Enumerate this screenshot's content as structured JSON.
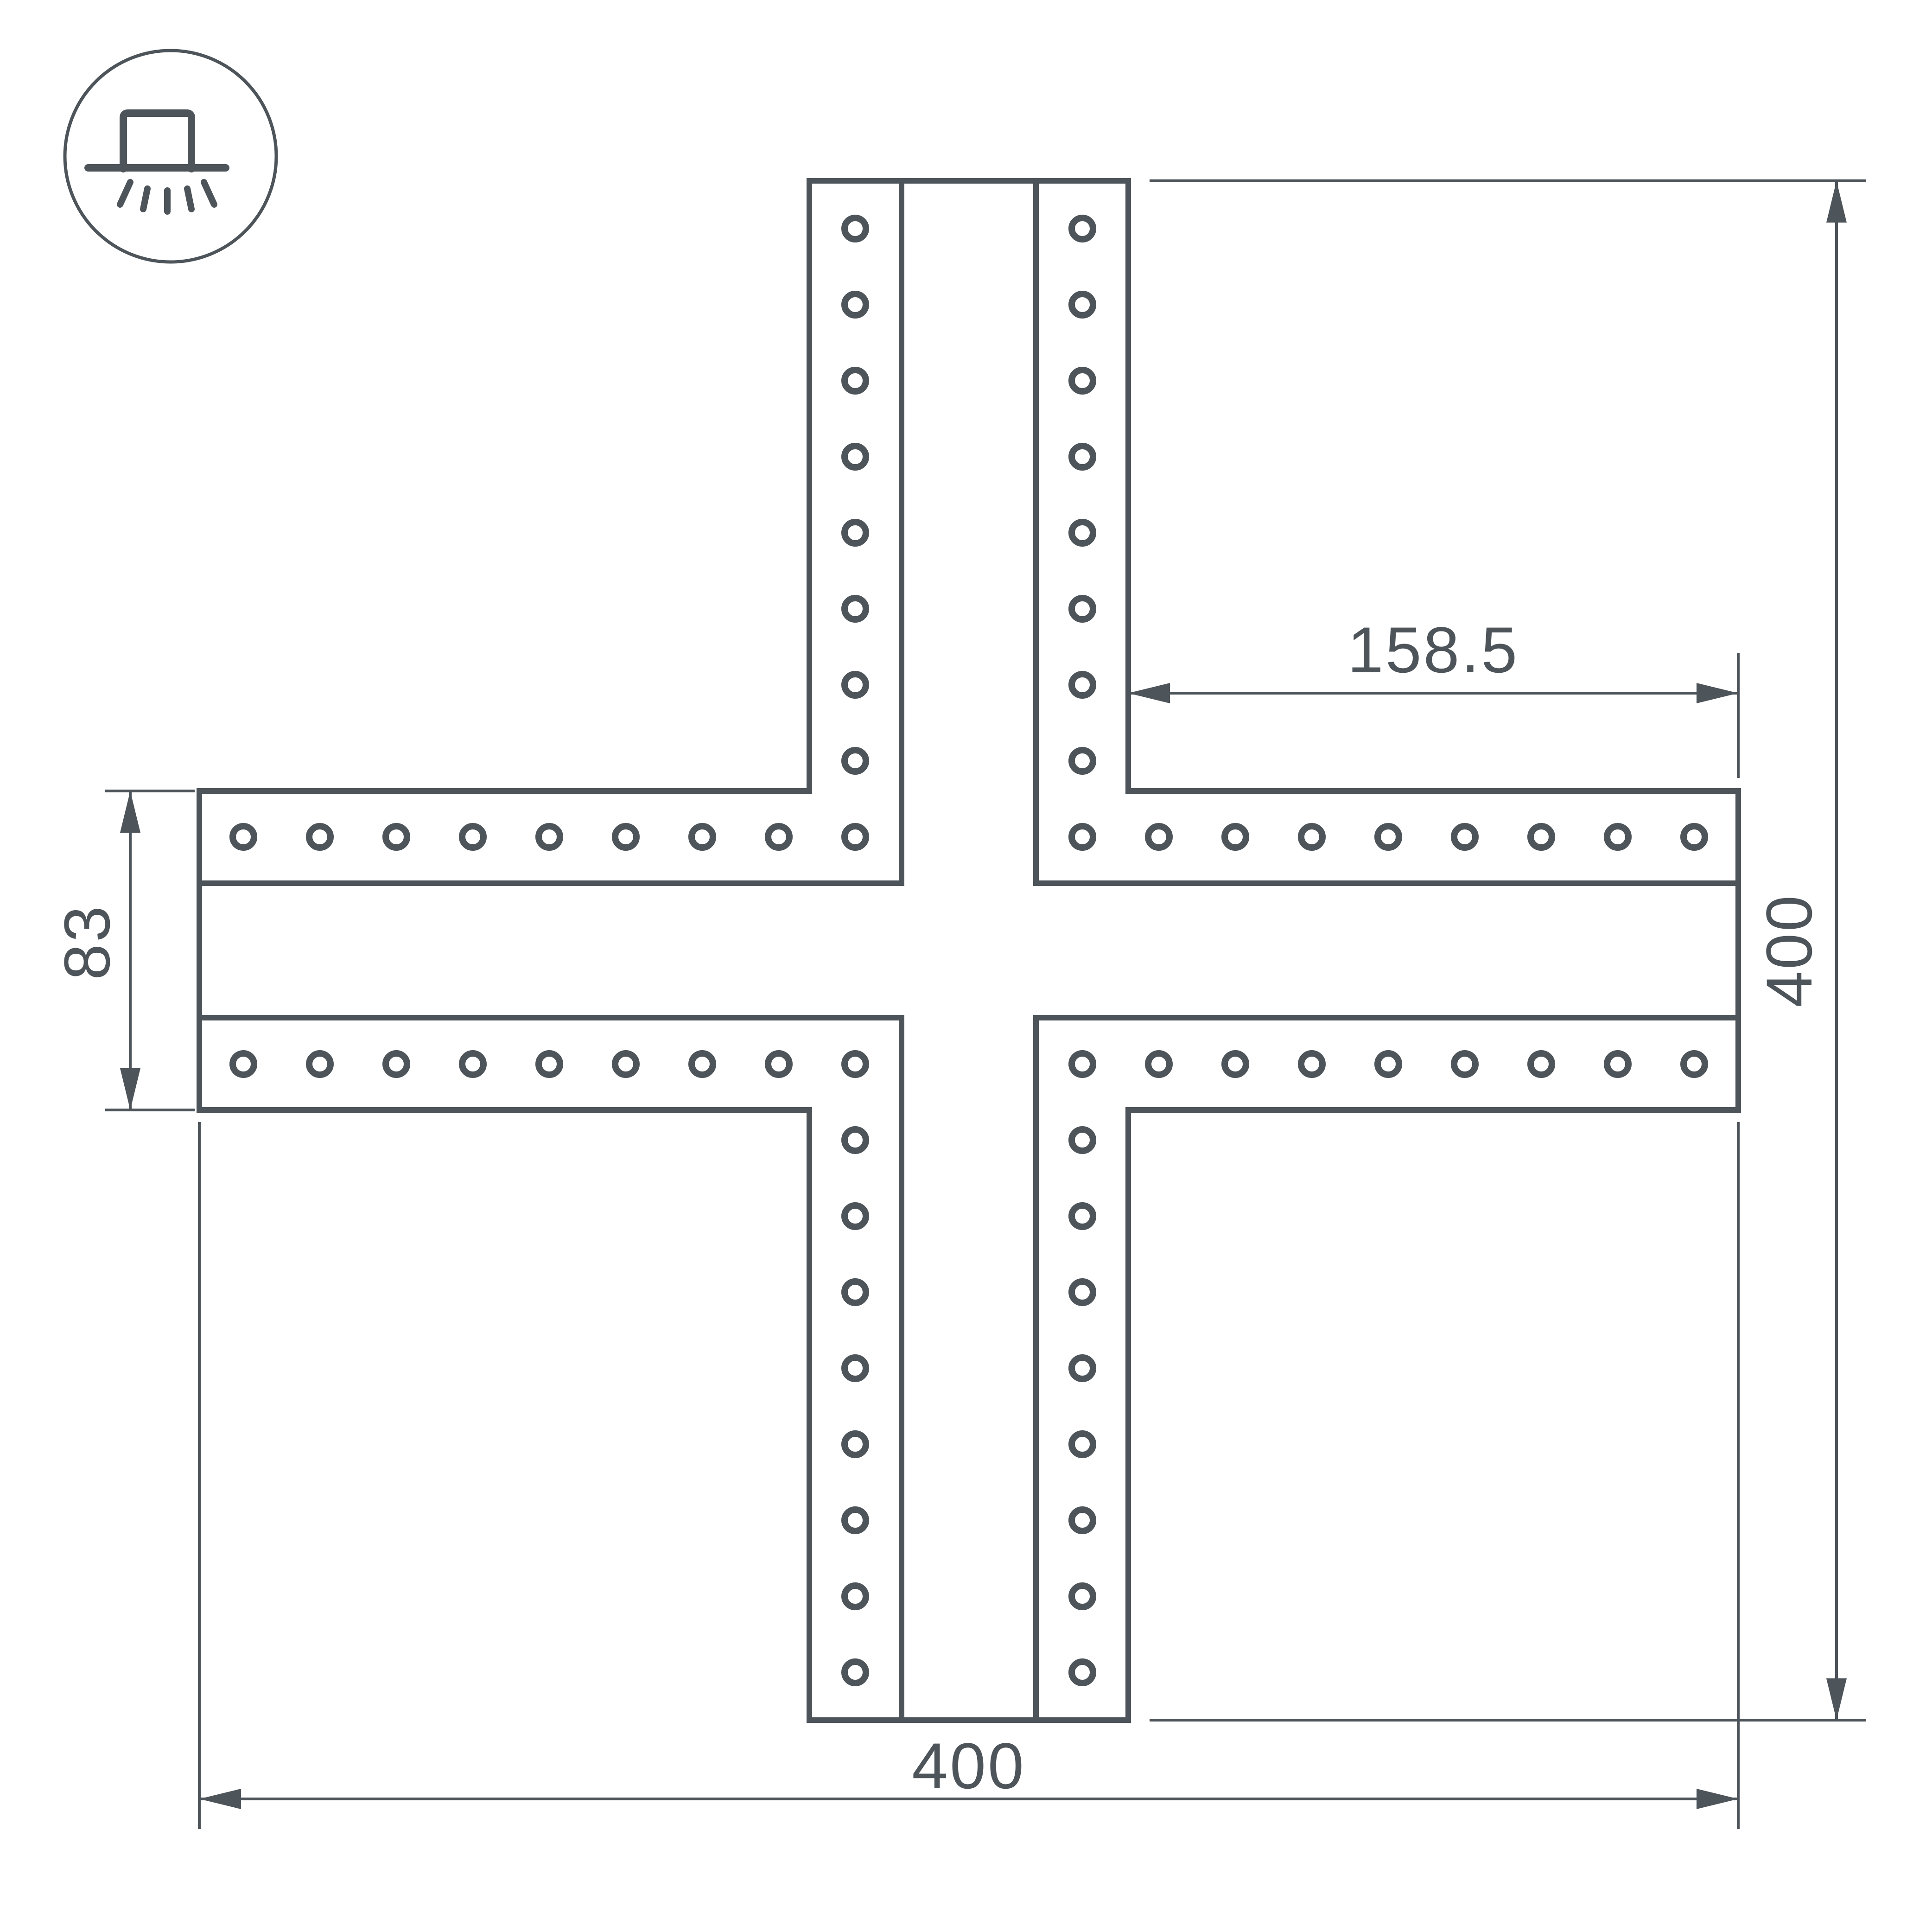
{
  "drawing": {
    "kind": "technical-dimensional-drawing",
    "icon": "surface-ceiling-light-icon",
    "colors": {
      "line": "#4d545a",
      "background": "#ffffff"
    },
    "dimensions": {
      "arm_length": "158.5",
      "profile_width": "83",
      "overall_height": "400",
      "overall_width": "400"
    }
  }
}
